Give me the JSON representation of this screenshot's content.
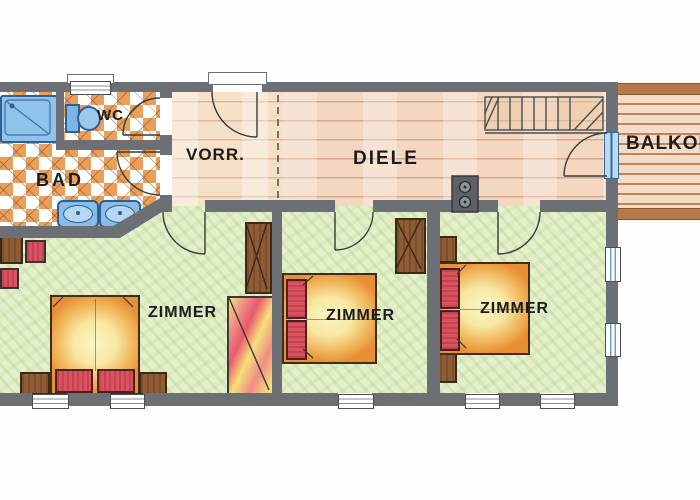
{
  "document": {
    "type": "hand-drawn apartment floor plan (scanned drawing)"
  },
  "rooms": {
    "bad": {
      "label": "BAD"
    },
    "wc": {
      "label": "WC"
    },
    "vorraum": {
      "label": "VORR."
    },
    "diele": {
      "label": "DIELE"
    },
    "balkon": {
      "label": "BALKON"
    },
    "zimmer_left": {
      "label": "ZIMMER"
    },
    "zimmer_middle": {
      "label": "ZIMMER"
    },
    "zimmer_right": {
      "label": "ZIMMER"
    }
  },
  "fixtures": [
    "bathtub",
    "toilet",
    "double-washbasin",
    "entrance-door",
    "staircase",
    "tiled-stove",
    "balcony-door",
    "double-bed",
    "nightstand",
    "wardrobe",
    "window",
    "door-swing"
  ],
  "colors": {
    "wall": "#6c7074",
    "tile_orange": "#eb9f58",
    "wood_floor": "#f5e0c8",
    "hall_floor": "#f3d7c0",
    "room_green": "#e5efcc",
    "fixture_blue": "#8fc3e9",
    "fixture_blue_dark": "#2e5f95",
    "bed_orange": "#e68f35",
    "bed_yellow": "#fbf4c6",
    "pillow_red": "#d95260",
    "furniture_brown": "#8f5c36",
    "balcony_brown": "#b5794a",
    "label_color": "#1c1c1c"
  }
}
